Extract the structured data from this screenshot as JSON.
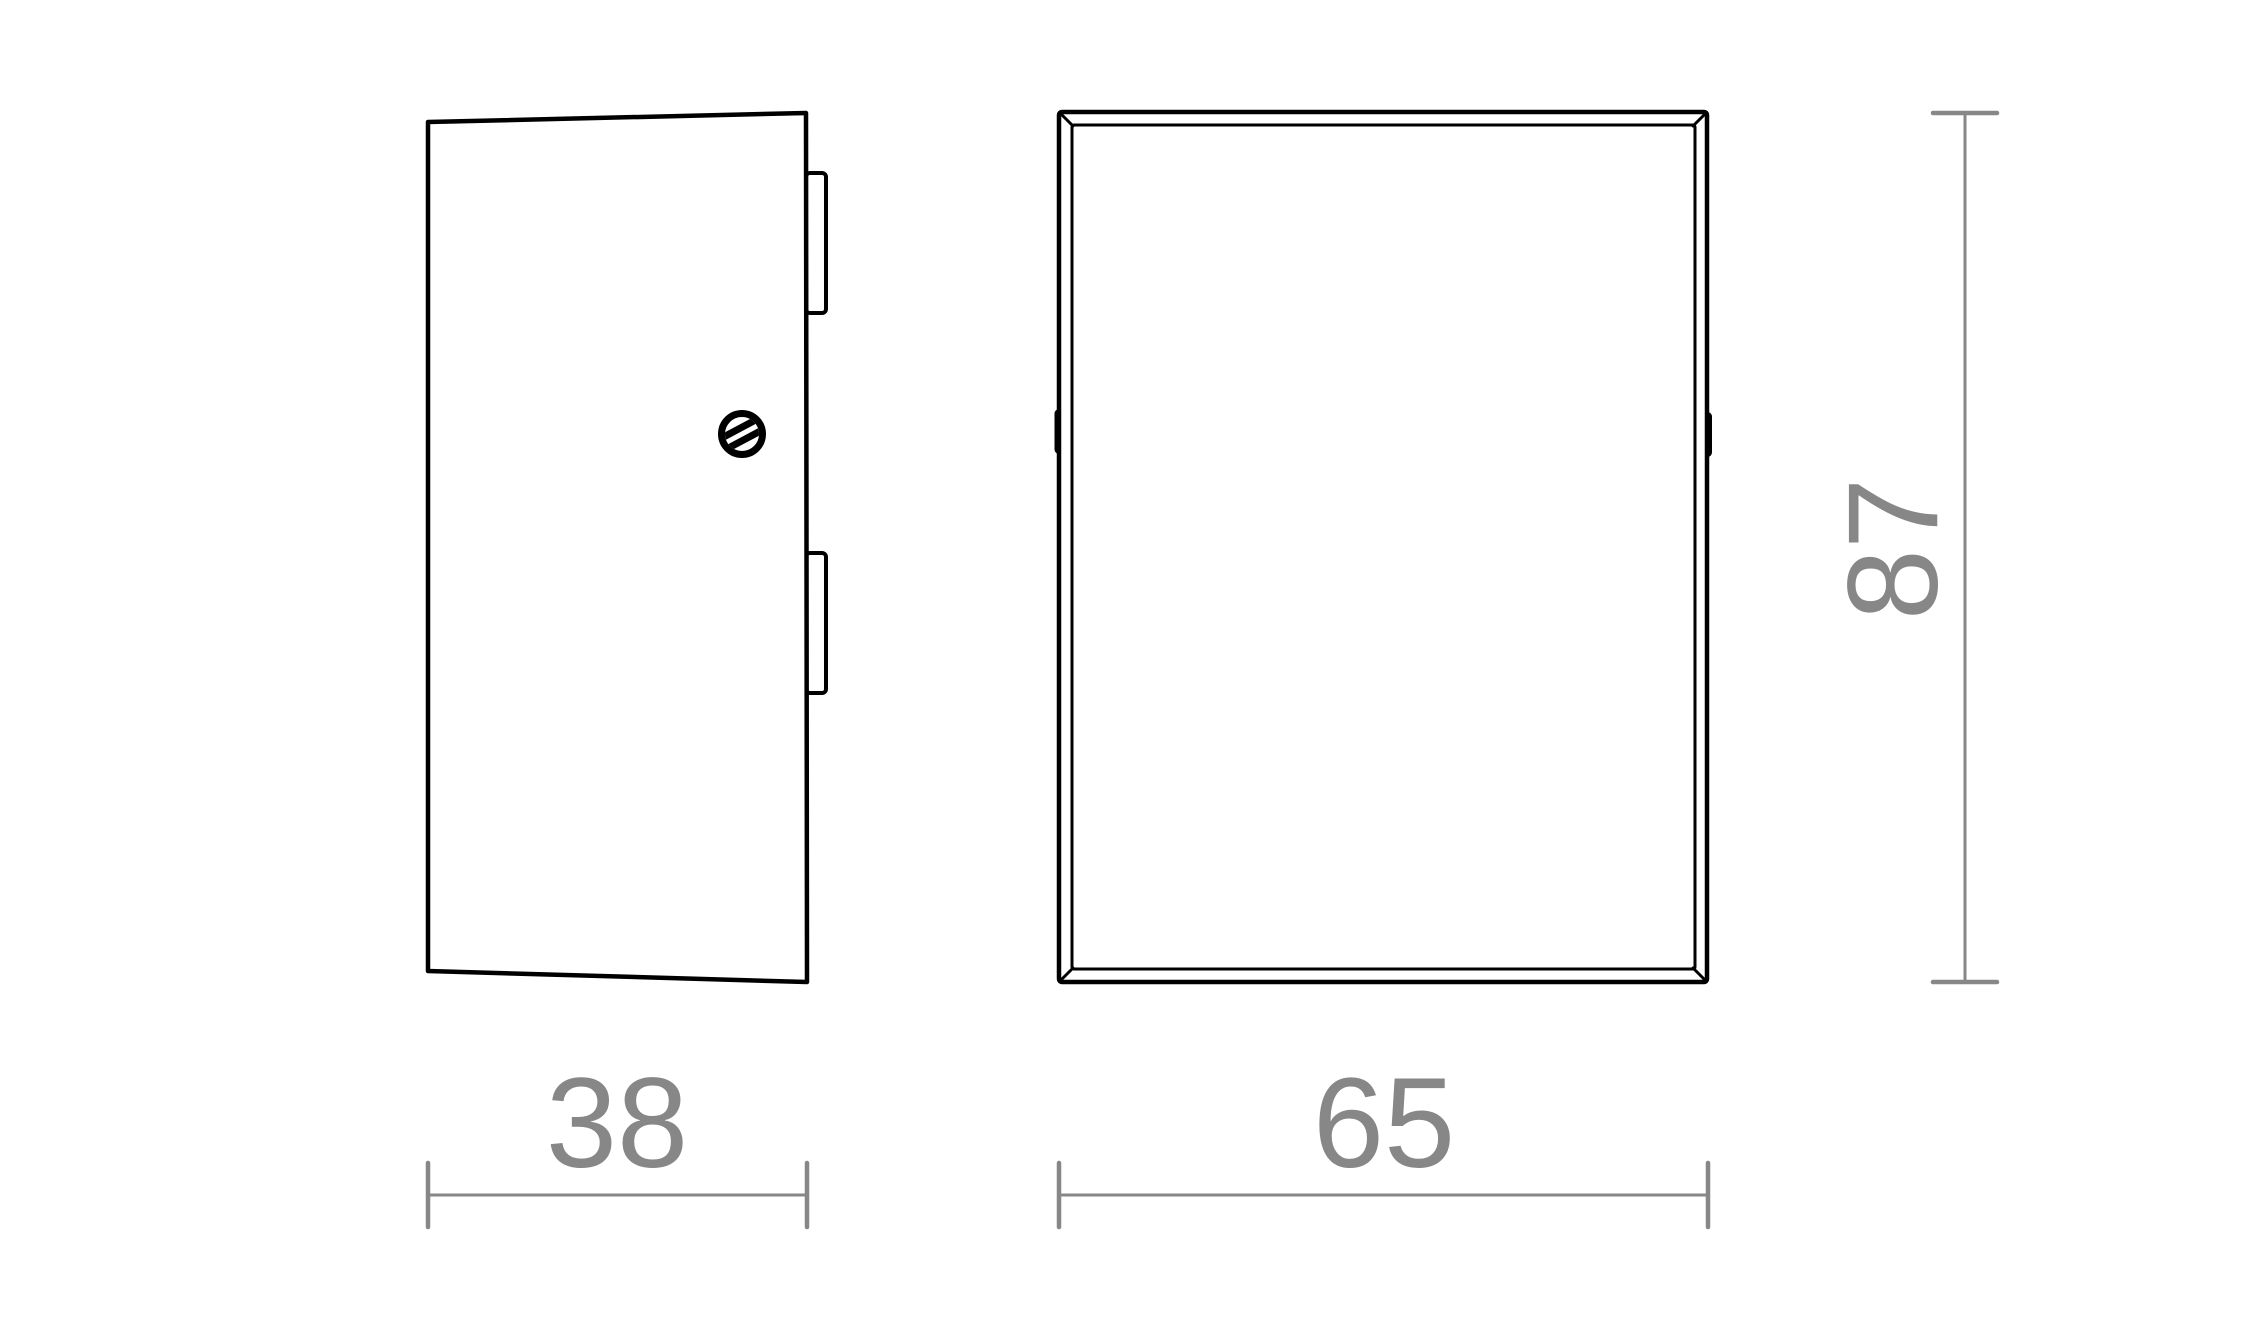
{
  "dimensions": {
    "depth": {
      "value": "38"
    },
    "width": {
      "value": "65"
    },
    "height": {
      "value": "87"
    }
  },
  "colors": {
    "outline": "#000000",
    "dimension": "#878787",
    "background": "#ffffff"
  },
  "icons": {
    "screw_head": "slotted-screw-circle"
  }
}
